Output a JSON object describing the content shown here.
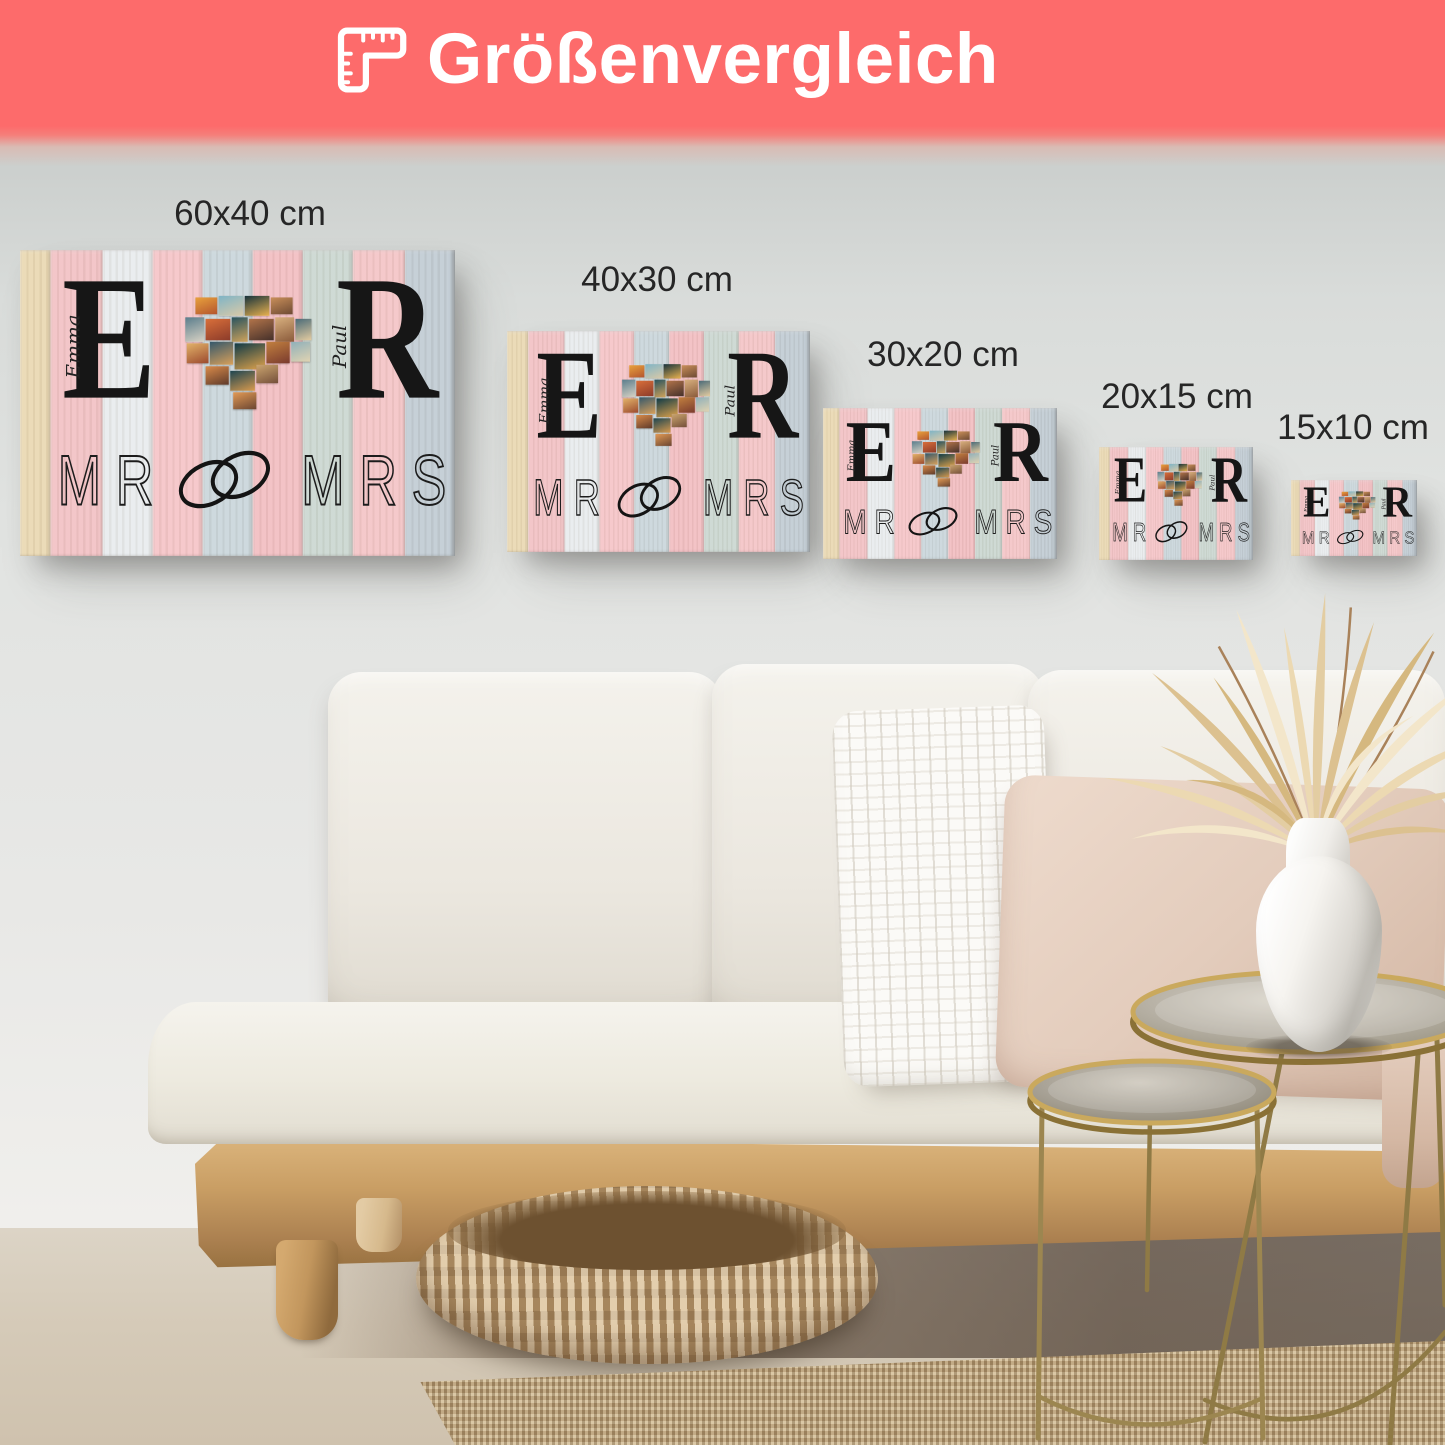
{
  "banner": {
    "title": "Größenvergleich",
    "icon": "corner-ruler",
    "background_color": "#fd6b6b",
    "text_color": "#ffffff"
  },
  "size_labels": [
    {
      "label": "60x40 cm"
    },
    {
      "label": "40x30 cm"
    },
    {
      "label": "30x20 cm"
    },
    {
      "label": "20x15 cm"
    },
    {
      "label": "15x10 cm"
    }
  ],
  "canvas_design": {
    "left_initial": "E",
    "left_name": "Emma",
    "right_initial": "R",
    "right_name": "Paul",
    "word_left": "MR",
    "word_right": "MRS",
    "center_motif": "heart-shaped photo collage",
    "rings_motif": "interlocked wedding rings",
    "plank_colors": [
      "#ead9b4",
      "#f2c3c6",
      "#e9ecee",
      "#f5c6c9",
      "#cbd7dc",
      "#f2bfc3",
      "#ccd8d2",
      "#f4c6c8",
      "#c2cdd5"
    ],
    "collage_colors": [
      [
        "#e8a13c",
        "#b4552e"
      ],
      [
        "#7fb4c6",
        "#d9c9a8"
      ],
      [
        "#16323c",
        "#e8b14e"
      ],
      [
        "#c98f5a",
        "#6e4a33"
      ],
      [
        "#5a7d8c",
        "#d8d2c4"
      ],
      [
        "#d96f3a",
        "#8c3b2a"
      ],
      [
        "#28535e",
        "#cfa35c"
      ],
      [
        "#b2744a",
        "#45302a"
      ],
      [
        "#d8b07f",
        "#8a5a3a"
      ],
      [
        "#4a6b78",
        "#e3cba0"
      ],
      [
        "#e2b269",
        "#9c4a2e"
      ],
      [
        "#35586b",
        "#d8a05a"
      ],
      [
        "#0f3a46",
        "#e0a34c"
      ],
      [
        "#c2803f",
        "#7a3b2e"
      ],
      [
        "#8fb0ba",
        "#e0d3b2"
      ],
      [
        "#d98b4a",
        "#5f3a2a"
      ],
      [
        "#1d4550",
        "#d89a4e"
      ],
      [
        "#cba56f",
        "#75503a"
      ],
      [
        "#e29a55",
        "#6b4632"
      ]
    ]
  },
  "scene": {
    "wall_color": "#dfe1e0",
    "floor_color": "#d6ccbc",
    "sofa_fabric_color": "#efece5",
    "wood_color": "#c49a62",
    "gold_color": "#b2975a",
    "rug_color": "#c1a77d",
    "pouf_color": "#c7a678",
    "pillow_knit_color": "#faf9f6",
    "pillow_blush_color": "#e4cfc0",
    "vase_color": "#f4f2ee",
    "dried_leaves_color": "#ecdab5"
  }
}
